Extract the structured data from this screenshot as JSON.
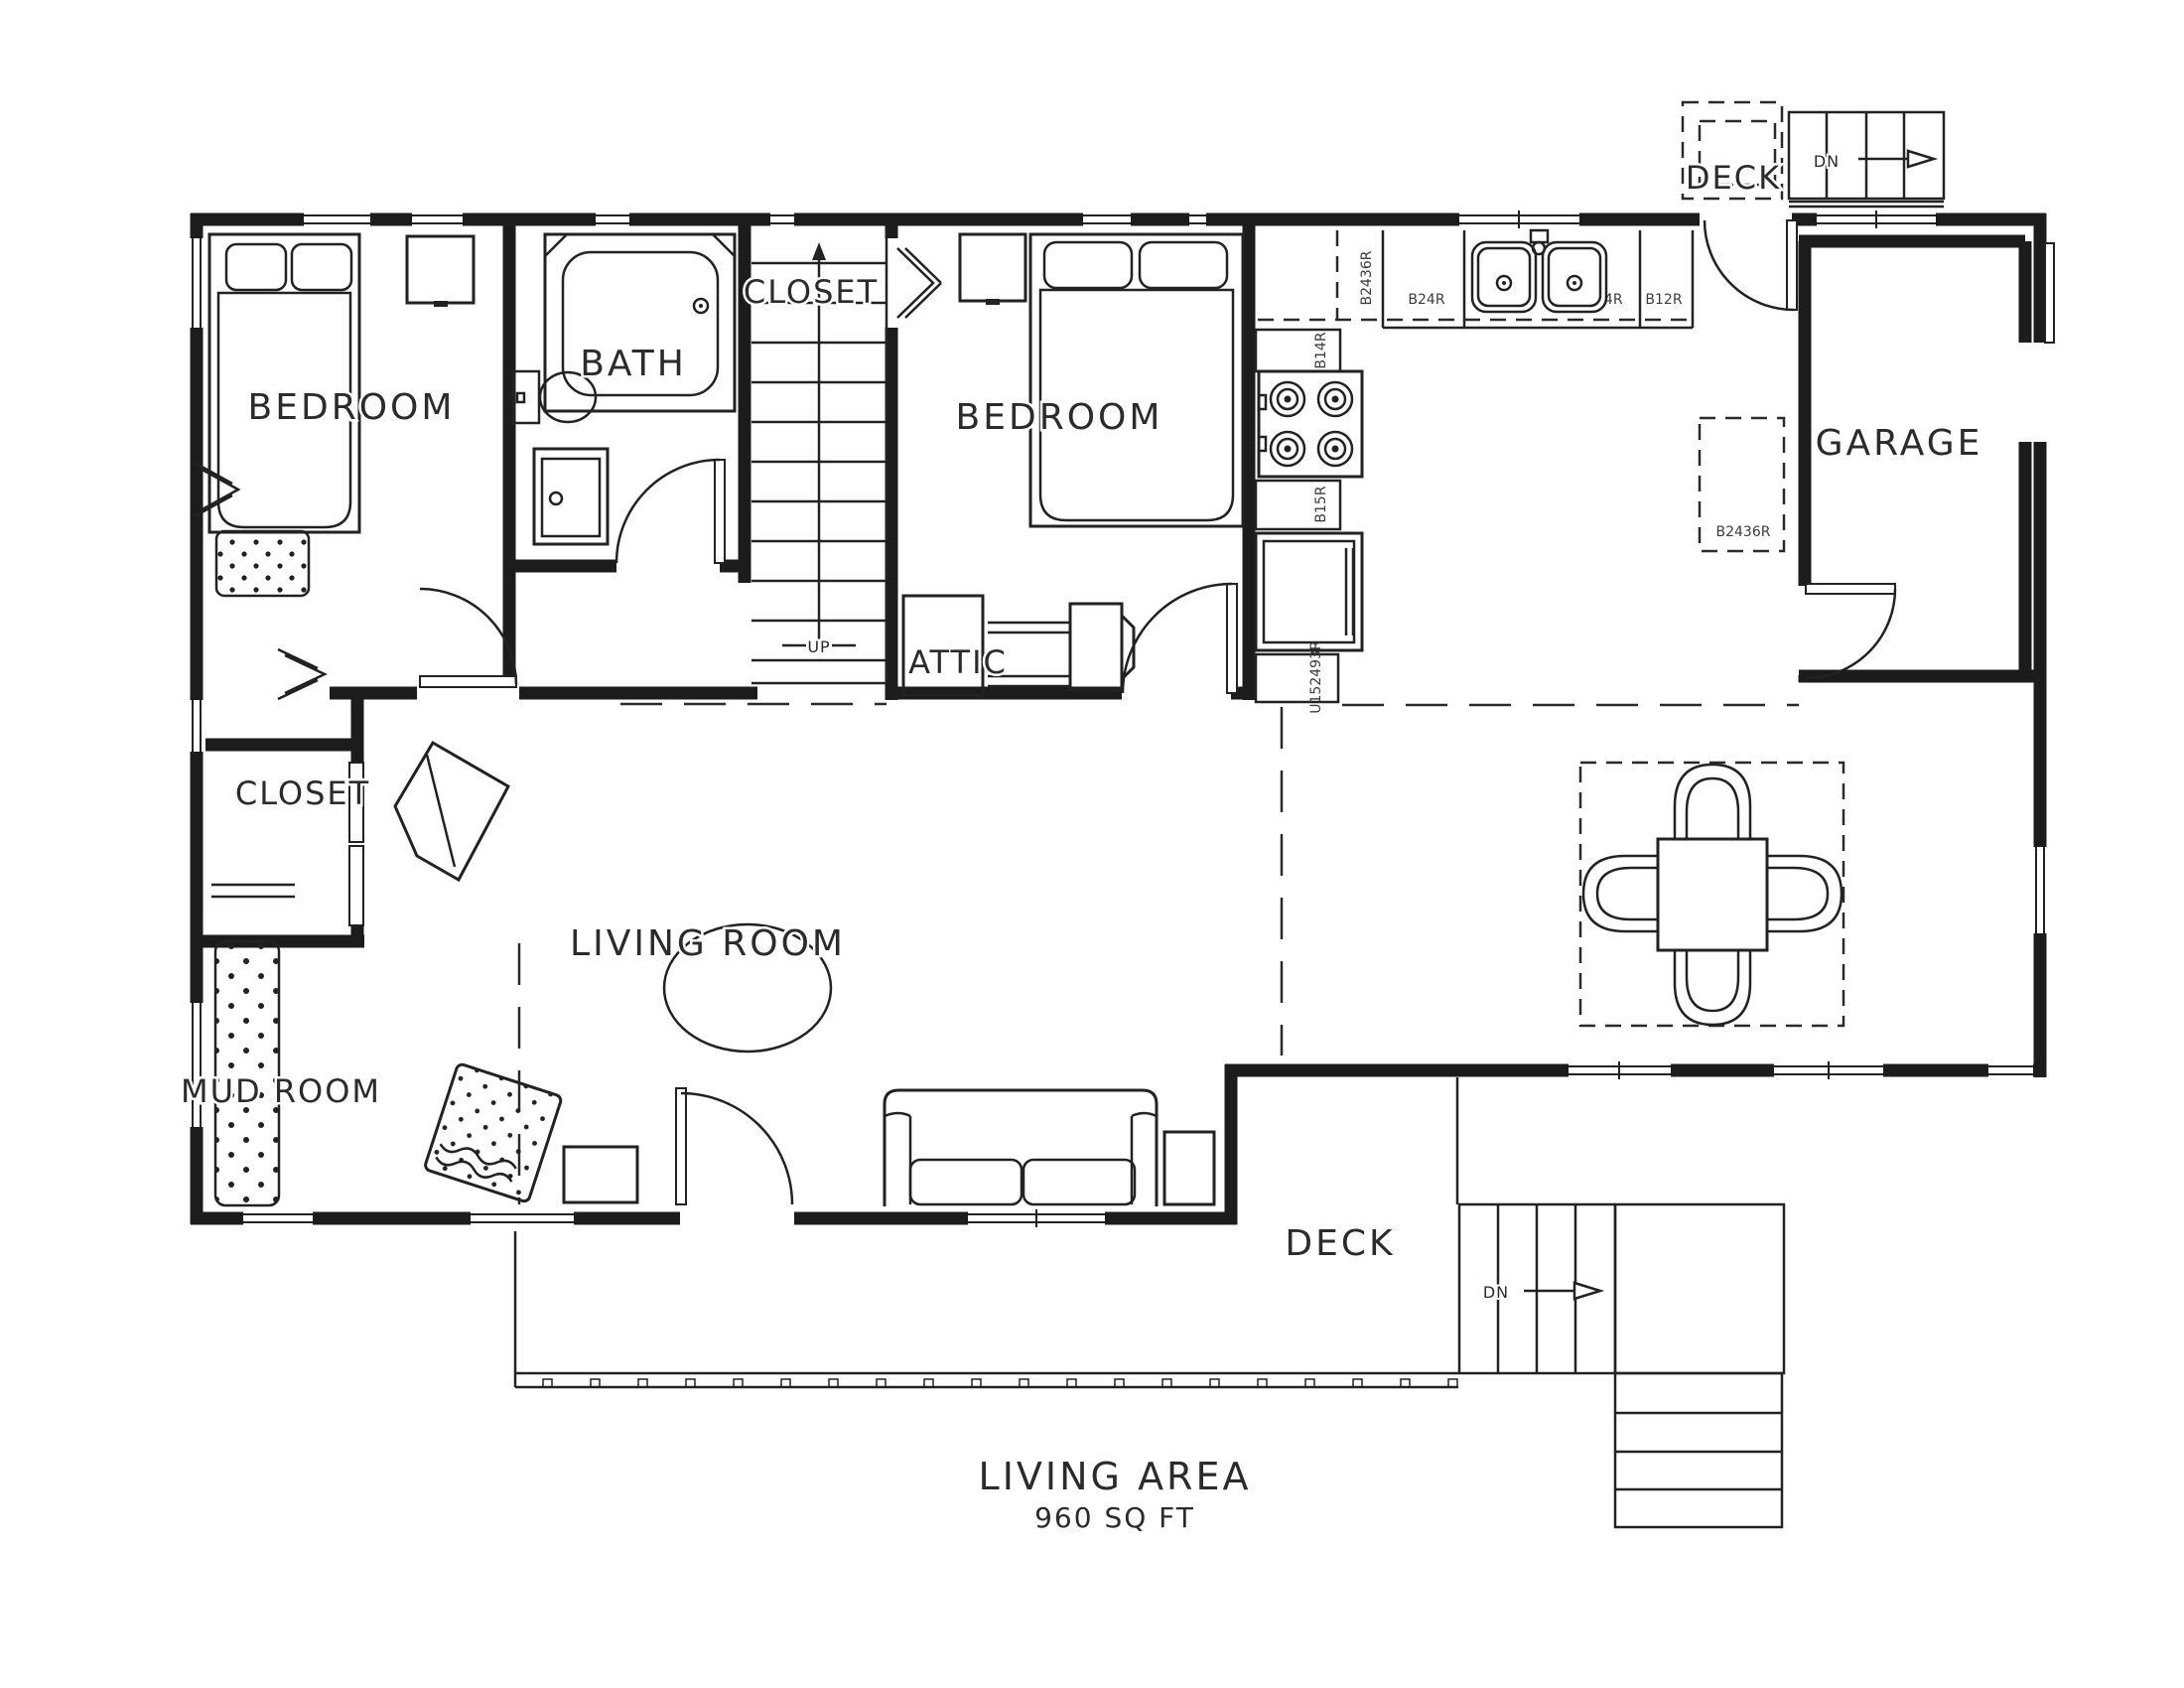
{
  "document": {
    "type": "architectural-floor-plan"
  },
  "rooms": {
    "bedroom_left": "BEDROOM",
    "bath": "BATH",
    "closet_upper": "CLOSET",
    "bedroom_middle": "BEDROOM",
    "attic": "ATTIC",
    "garage": "GARAGE",
    "closet_left": "CLOSET",
    "living_room": "LIVING ROOM",
    "mud_room": "MUD ROOM",
    "deck_upper": "DECK",
    "deck_lower": "DECK"
  },
  "stairs": {
    "up_label": "UP",
    "down_upper": "DN",
    "down_lower": "DN"
  },
  "cabinets": {
    "corner_upper": "B2436R",
    "base_b24": "B24R",
    "base_sink": "B24R",
    "base_b12": "B12R",
    "base_b14": "B14R",
    "base_b15": "B15R",
    "utility": "U152493R",
    "pantry": "B2436R"
  },
  "summary": {
    "title": "LIVING AREA",
    "area": "960 SQ FT"
  },
  "colors": {
    "ink": "#1c1c1c",
    "label": "#2b2b2b",
    "paper": "#ffffff"
  }
}
